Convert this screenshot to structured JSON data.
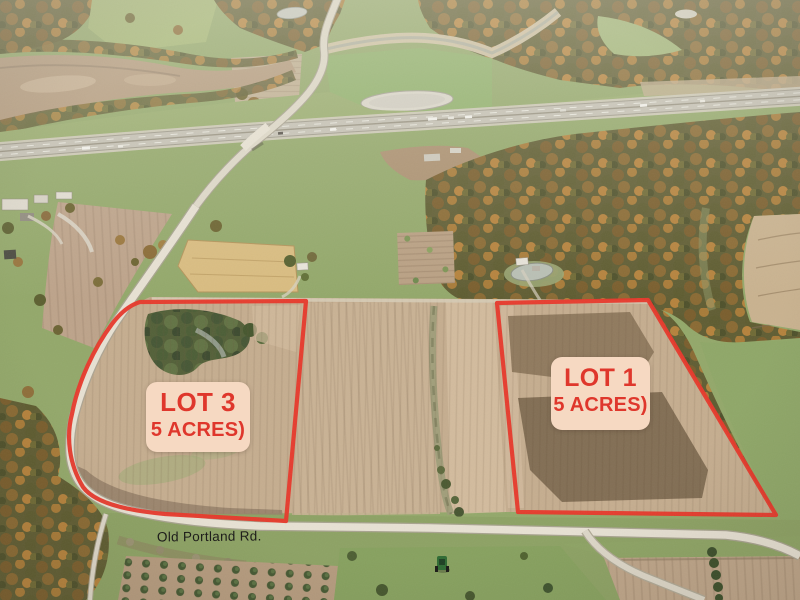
{
  "photo": {
    "kind": "aerial-lot-photo",
    "road_label": "Old Portland Rd.",
    "lots": [
      {
        "name": "LOT 3",
        "size": "5 ACRES)"
      },
      {
        "name": "LOT 1",
        "size": "5 ACRES)"
      }
    ],
    "colors": {
      "outline": "#e7382b",
      "label_bg": "#f6d9c2",
      "label_text": "#df372c",
      "road_text": "#1e1d1b"
    }
  }
}
